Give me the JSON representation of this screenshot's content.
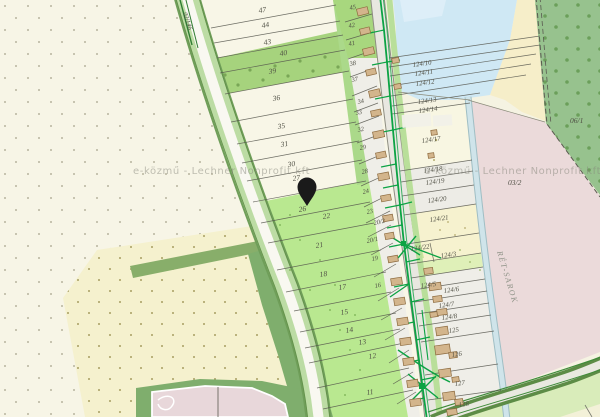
{
  "map": {
    "type": "cadastral-parcel-map",
    "watermark": {
      "text": "e-közmű - Lechner Nonprofit kft"
    },
    "marker": {
      "type": "location-pin",
      "color": "#1a1a1a"
    },
    "areas": {
      "forest_parcel": "06/1",
      "meadow_parcel": "03/2",
      "street_name": "RÉT-SAROK",
      "road_parcel": "02/146"
    },
    "parcels": {
      "left": [
        "47",
        "44",
        "43",
        "40",
        "39",
        "36",
        "35",
        "31",
        "30",
        "27",
        "26",
        "22",
        "21",
        "18",
        "17",
        "15",
        "14",
        "13",
        "12",
        "11"
      ],
      "right": [
        "45",
        "42",
        "41",
        "38",
        "37",
        "34",
        "33",
        "32",
        "29",
        "28",
        "24",
        "23",
        "20/2",
        "20/1",
        "19",
        "16"
      ],
      "east": [
        "124/10",
        "124/11",
        "124/12",
        "124/13",
        "124/14",
        "124/17",
        "124/18",
        "124/19",
        "124/20",
        "124/21",
        "124/22",
        "124/3",
        "124/5",
        "124/6",
        "124/7",
        "124/8",
        "125",
        "126",
        "127",
        "128"
      ]
    },
    "colors": {
      "cream": "#f7f5e6",
      "yellow_field": "#f5f1ce",
      "bright_green": "#b9e890",
      "medium_green": "#a6d37d",
      "dark_green": "#7fae6d",
      "forest": "#97c28e",
      "water": "#cfe8f4",
      "sand": "#f6eec9",
      "pink": "#ebdada",
      "road_white": "#f9f8f1",
      "road_gray": "#e7e6df",
      "utility_green": "#0ca344",
      "building": "#d3b58c",
      "pin": "#1a1a1a"
    }
  }
}
